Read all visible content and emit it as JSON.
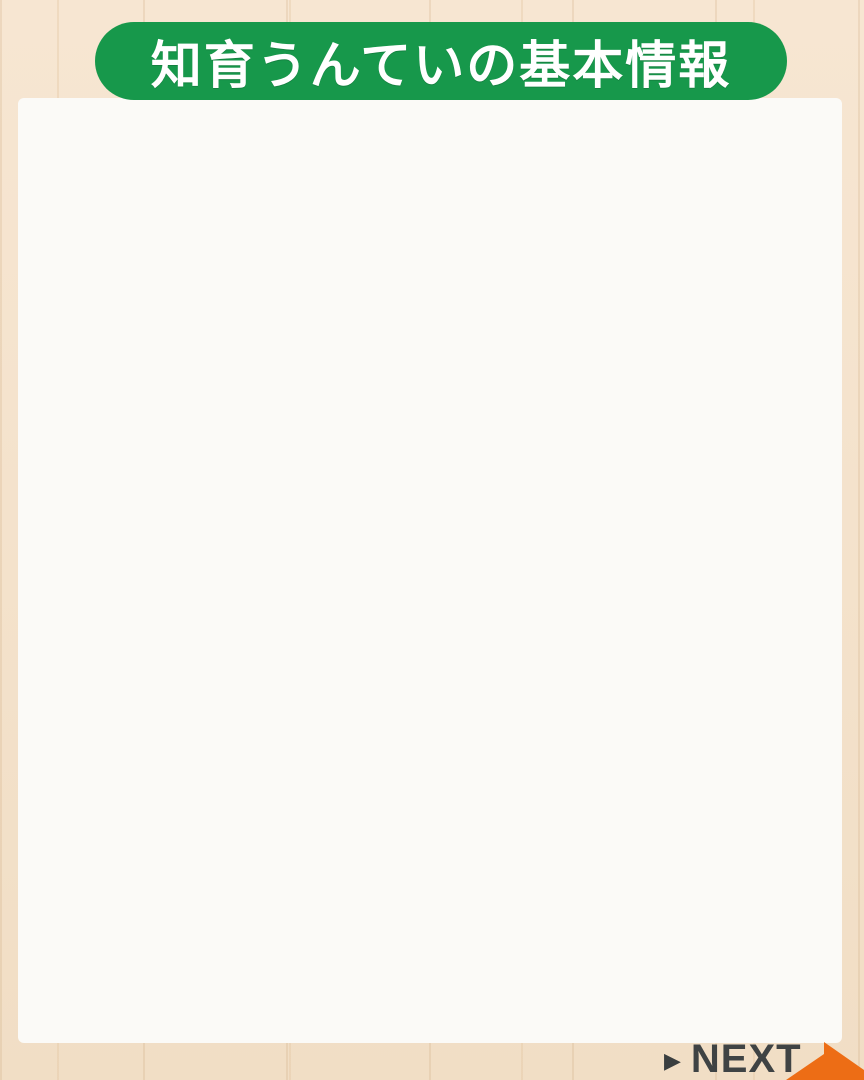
{
  "header": {
    "title": "知育うんていの基本情報"
  },
  "info": {
    "highlight": "ご自宅や用途に\nあわせてサイズ\n変更可能です。",
    "body": "重さは30キロほど\nなので、大人2人\nであれば持ち上げ\nて動かすことが可\n能です。\n片側ずつ持ち上げ\nてずらしていけ\nば、大人1人でも\n動かすことができ\nます。"
  },
  "diagram": {
    "description": "wooden monkey bars product photo with dimensions",
    "height_label": "197cm",
    "inner_span_label": "165cm",
    "rung_width_label": "40cm",
    "base_depth_label": "91cm",
    "total_width_label": "183cm"
  },
  "price": {
    "title": "うんてい基本価格 120,000円"
  },
  "spec_table": {
    "rows": [
      {
        "label": "重さ",
        "value": "約30キロ"
      },
      {
        "label": "横幅",
        "value": "183cm"
      },
      {
        "label": "高さ",
        "value": "197cm"
      },
      {
        "label": "うんてい幅",
        "value": "40cm"
      },
      {
        "label": "奥行き(土台)",
        "value": "91cm"
      },
      {
        "label": "うんてい内寸",
        "value": "165cm"
      },
      {
        "label": "握り棒（木製）",
        "value": "25mm径\n（20cm間隔× ９本）"
      }
    ]
  },
  "footer": {
    "next_icon": "▶",
    "next_label": "NEXT"
  },
  "colors": {
    "accent_green": "#17984b",
    "accent_orange": "#e6792c",
    "table_border_orange": "#e8873d",
    "arrow_orange": "#ed6d15",
    "text_dark": "#1d1d1d",
    "next_text": "#3f4344",
    "page_background": "#f5e3cd"
  }
}
